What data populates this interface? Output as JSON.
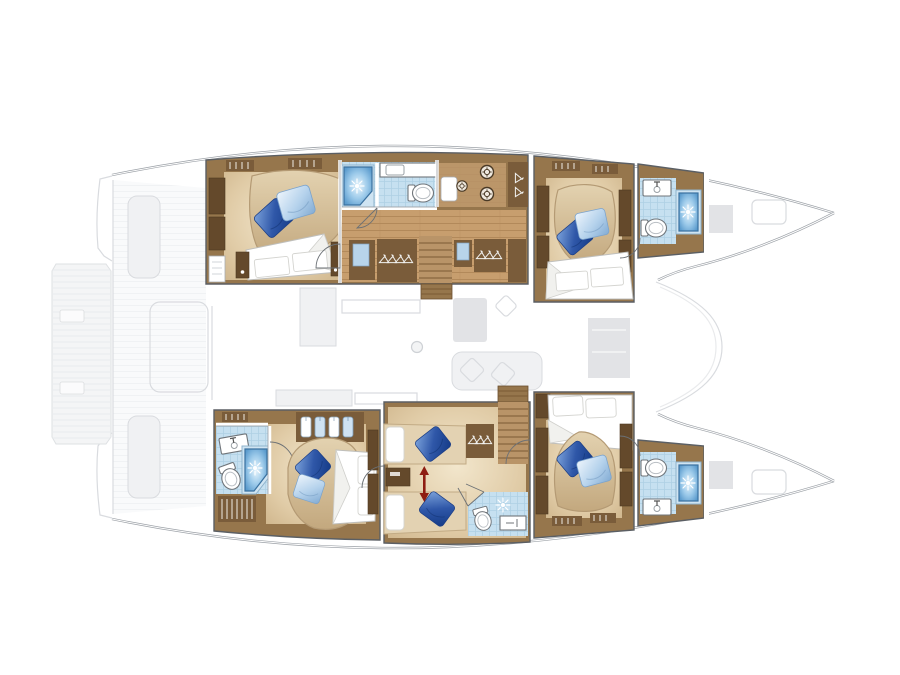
{
  "diagram_kind": "catamaran-yacht-floor-plan",
  "colors": {
    "hull_outline": "#9ca1a7",
    "ghost_fill": "#eff0f2",
    "ghost_fill_dark": "#dfe1e4",
    "ghost_stroke": "#d5d8dc",
    "box_stroke": "#5b5f64",
    "wood_dark": "#7a5c3a",
    "wood_mid": "#96764c",
    "wood_light": "#b99468",
    "panel_dark": "#64492b",
    "plank": "#c79e6e",
    "plank_line": "#b2895a",
    "floor_tan": "#e0cba6",
    "bath_floor": "#c6e0f0",
    "bath_grid": "#afd0e4",
    "shower_rim": "#3a719f",
    "shower_mid": "#9ccaea",
    "shower_deep": "#5b9bcd",
    "pillow_dark": "#2f57a8",
    "pillow_light": "#b5d2ec",
    "fixture_stroke": "#70757a",
    "red_arrow": "#8e1d12",
    "white": "#ffffff"
  },
  "rooms": [
    {
      "id": "port-aft-cabin",
      "features": [
        "double-bed",
        "blue-pillows",
        "wardrobe",
        "nightstands"
      ]
    },
    {
      "id": "port-aft-bathroom",
      "features": [
        "shower",
        "toilet",
        "vanity-sink"
      ]
    },
    {
      "id": "port-companionway",
      "features": [
        "stairs",
        "hanging-lockers",
        "galley-sink",
        "burners",
        "mirror-cabinets"
      ]
    },
    {
      "id": "port-forward-cabin",
      "features": [
        "double-bed",
        "blue-pillows",
        "shelving"
      ]
    },
    {
      "id": "port-forward-bathroom",
      "features": [
        "shower",
        "toilet",
        "vanity-sink"
      ]
    },
    {
      "id": "starboard-aft-bathroom",
      "features": [
        "shower",
        "toilet",
        "vanity-sink",
        "louvered-locker"
      ]
    },
    {
      "id": "starboard-aft-cabin",
      "features": [
        "double-bed",
        "blue-pillows",
        "hanging-locker"
      ]
    },
    {
      "id": "starboard-midship-cabin",
      "features": [
        "twin-beds",
        "convertible-arrow",
        "stairs",
        "hanging-locker",
        "ensuite-bathroom"
      ]
    },
    {
      "id": "starboard-forward-cabin",
      "features": [
        "double-bed",
        "blue-pillows",
        "shelving"
      ]
    },
    {
      "id": "starboard-forward-bathroom",
      "features": [
        "shower",
        "toilet",
        "vanity-sink"
      ]
    }
  ],
  "ghost_elements": [
    "swim-platform",
    "transom-steps",
    "cockpit-benches",
    "cockpit-table",
    "saloon-sofa",
    "saloon-table",
    "galley-blocks",
    "mast-base",
    "coachroof-front",
    "foredeck-hatches"
  ],
  "icons": [
    "shower-spray-icon",
    "toilet-icon",
    "sink-icon",
    "burner-icon",
    "hanger-icon",
    "shirt-icon",
    "stairs-icon",
    "door-arc-icon",
    "mast-icon",
    "pillow-icon",
    "red-double-arrow-icon"
  ]
}
